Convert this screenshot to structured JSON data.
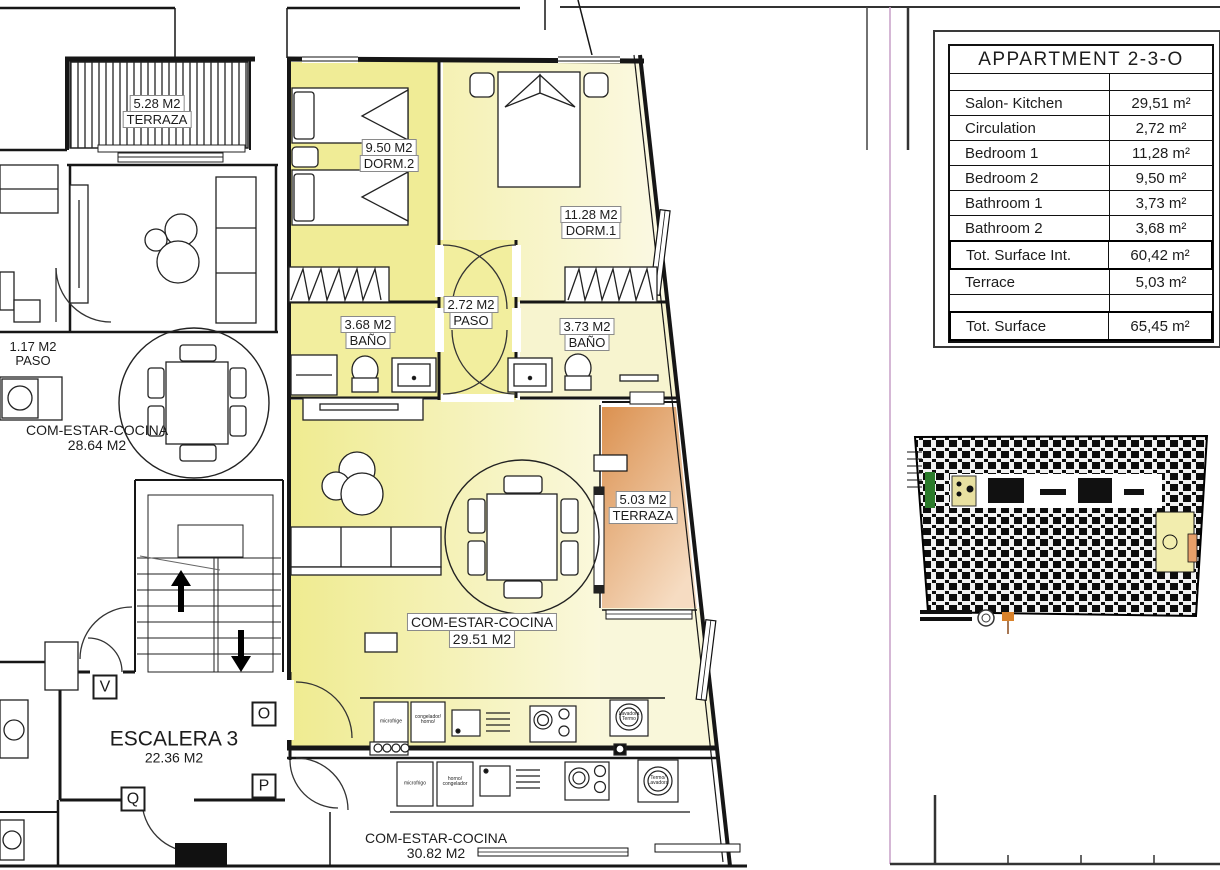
{
  "plan": {
    "rooms": {
      "terraza_528": {
        "area": "5.28 M2",
        "name": "TERRAZA"
      },
      "dorm2": {
        "area": "9.50 M2",
        "name": "DORM.2"
      },
      "dorm1": {
        "area": "11.28 M2",
        "name": "DORM.1"
      },
      "paso_272": {
        "area": "2.72 M2",
        "name": "PASO"
      },
      "bano_368": {
        "area": "3.68 M2",
        "name": "BAÑO"
      },
      "bano_373": {
        "area": "3.73 M2",
        "name": "BAÑO"
      },
      "paso_117": {
        "area": "1.17 M2",
        "name": "PASO"
      },
      "salon_2864": {
        "name": "COM-ESTAR-COCINA",
        "area": "28.64 M2"
      },
      "terraza_503": {
        "area": "5.03 M2",
        "name": "TERRAZA"
      },
      "salon_2951": {
        "name": "COM-ESTAR-COCINA",
        "area": "29.51 M2"
      },
      "escalera": {
        "name": "ESCALERA 3",
        "area": "22.36 M2"
      },
      "salon_3082": {
        "name": "COM-ESTAR-COCINA",
        "area": "30.82 M2"
      }
    },
    "door_letters": {
      "v": "V",
      "o": "O",
      "p": "P",
      "q": "Q"
    },
    "appliances": {
      "kitchen1": {
        "fridge": "microfrige",
        "freezer": "congelador/\nhorno/",
        "washer": "Lavadora\nTermo"
      },
      "kitchen2": {
        "fridge": "microfrigo",
        "oven": "horno/\ncongelador",
        "washer": "Termo/\nLavadora"
      }
    }
  },
  "summary_table": {
    "title": "APPARTMENT 2-3-O",
    "rows": [
      {
        "label": "Salon- Kitchen",
        "value": "29,51 m²"
      },
      {
        "label": "Circulation",
        "value": "2,72 m²"
      },
      {
        "label": "Bedroom 1",
        "value": "11,28 m²"
      },
      {
        "label": "Bedroom 2",
        "value": "9,50 m²"
      },
      {
        "label": "Bathroom 1",
        "value": "3,73 m²"
      },
      {
        "label": "Bathroom 2",
        "value": "3,68 m²"
      },
      {
        "label": "Tot. Surface Int.",
        "value": "60,42 m²"
      },
      {
        "label": "Terrace",
        "value": "5,03 m²"
      },
      {
        "label": "Tot. Surface",
        "value": "65,45 m²"
      }
    ]
  },
  "colors": {
    "room_yellow": "#f0ec96",
    "room_pale": "#f8f5d2",
    "terrace_orange": "#dd9551",
    "sheet_line_magenta": "#c79fc7",
    "wall": "#1a1a1a",
    "keyplan_highlight": "#f2edae"
  }
}
